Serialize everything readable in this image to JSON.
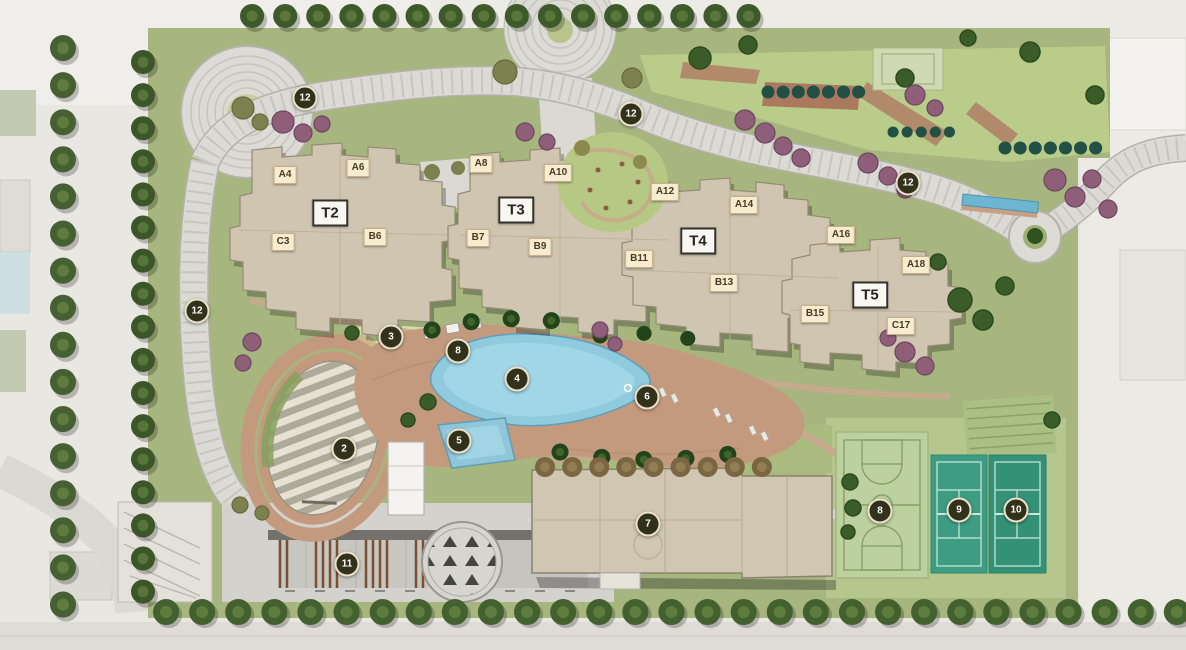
{
  "plan": {
    "towers": [
      {
        "label": "T2",
        "x": 330,
        "y": 213
      },
      {
        "label": "T3",
        "x": 516,
        "y": 210
      },
      {
        "label": "T4",
        "x": 698,
        "y": 241
      },
      {
        "label": "T5",
        "x": 870,
        "y": 295
      }
    ],
    "units": [
      {
        "label": "A4",
        "x": 285,
        "y": 175
      },
      {
        "label": "A6",
        "x": 358,
        "y": 168
      },
      {
        "label": "A8",
        "x": 481,
        "y": 164
      },
      {
        "label": "A10",
        "x": 558,
        "y": 173
      },
      {
        "label": "A12",
        "x": 665,
        "y": 192
      },
      {
        "label": "A14",
        "x": 744,
        "y": 205
      },
      {
        "label": "A16",
        "x": 841,
        "y": 235
      },
      {
        "label": "A18",
        "x": 916,
        "y": 265
      },
      {
        "label": "B6",
        "x": 375,
        "y": 237
      },
      {
        "label": "B7",
        "x": 478,
        "y": 238
      },
      {
        "label": "B9",
        "x": 540,
        "y": 247
      },
      {
        "label": "B11",
        "x": 639,
        "y": 259
      },
      {
        "label": "B13",
        "x": 724,
        "y": 283
      },
      {
        "label": "B15",
        "x": 815,
        "y": 314
      },
      {
        "label": "C3",
        "x": 283,
        "y": 242
      },
      {
        "label": "C17",
        "x": 901,
        "y": 326
      }
    ],
    "amenity_markers": [
      {
        "number": "2",
        "x": 344,
        "y": 449
      },
      {
        "number": "3",
        "x": 391,
        "y": 337
      },
      {
        "number": "4",
        "x": 517,
        "y": 379
      },
      {
        "number": "5",
        "x": 459,
        "y": 441
      },
      {
        "number": "6",
        "x": 647,
        "y": 397
      },
      {
        "number": "7",
        "x": 648,
        "y": 524
      },
      {
        "number": "8",
        "x": 458,
        "y": 351
      },
      {
        "number": "8",
        "x": 880,
        "y": 511
      },
      {
        "number": "9",
        "x": 959,
        "y": 510
      },
      {
        "number": "10",
        "x": 1016,
        "y": 510
      },
      {
        "number": "11",
        "x": 347,
        "y": 564
      },
      {
        "number": "12",
        "x": 305,
        "y": 98
      },
      {
        "number": "12",
        "x": 631,
        "y": 114
      },
      {
        "number": "12",
        "x": 908,
        "y": 183
      },
      {
        "number": "12",
        "x": 197,
        "y": 311
      }
    ],
    "colors": {
      "site_green": "#a6b67e",
      "lawn_light": "#c3d494",
      "building_beige": "#cfc5b0",
      "road_grey": "#dbdad4",
      "deck_tan": "#c49a7e",
      "pool_blue": "#8fcade",
      "tennis_teal": "#3d9c82",
      "basketball_green": "#bdd09f",
      "tree_green": "#3a5c28",
      "tree_purple": "#8f5e79",
      "marker_bg": "#32321b",
      "marker_ring": "#eae2cb",
      "chip_bg": "#f5ecd2",
      "chip_text": "#4a3a1e"
    }
  }
}
